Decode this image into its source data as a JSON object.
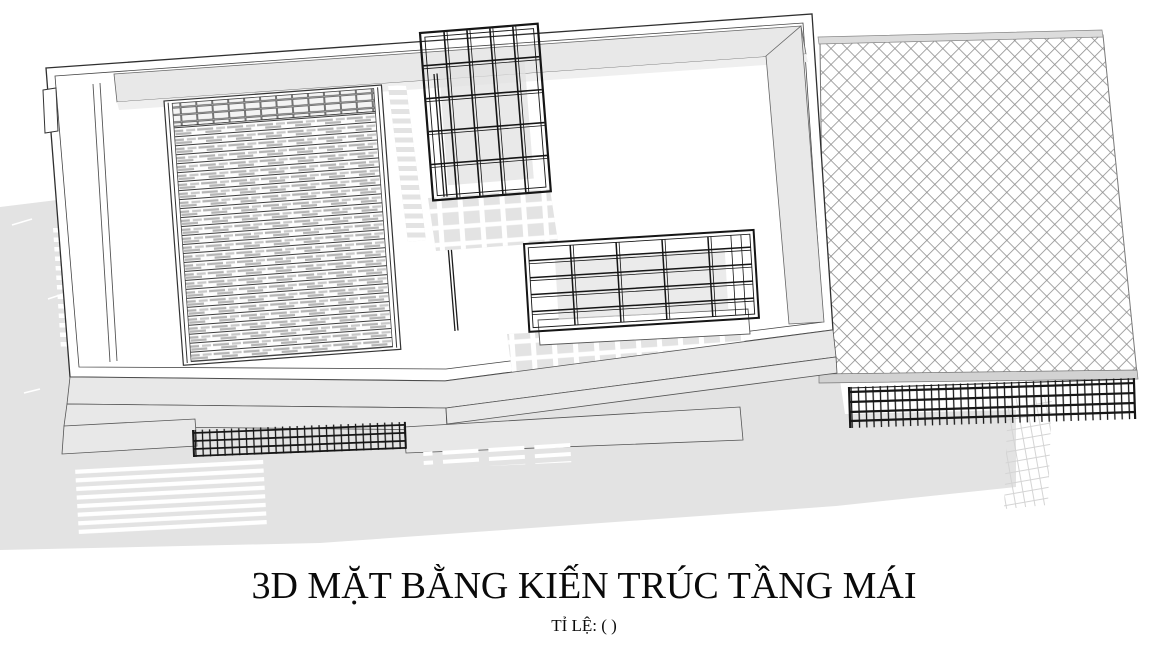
{
  "title": {
    "text": "3D MẶT BẰNG KIẾN TRÚC TẦNG MÁI"
  },
  "subtitle": {
    "text": "TỈ LỆ: ( )"
  },
  "colors": {
    "line": "#2f2f2f",
    "panel_gray": "#e8e8e8",
    "shadow_gray": "#e3e3e3",
    "railing_dark": "#161616",
    "hatch_line": "#8f8f8f",
    "louver_dash": "#b5b5b5",
    "background": "#ffffff"
  }
}
